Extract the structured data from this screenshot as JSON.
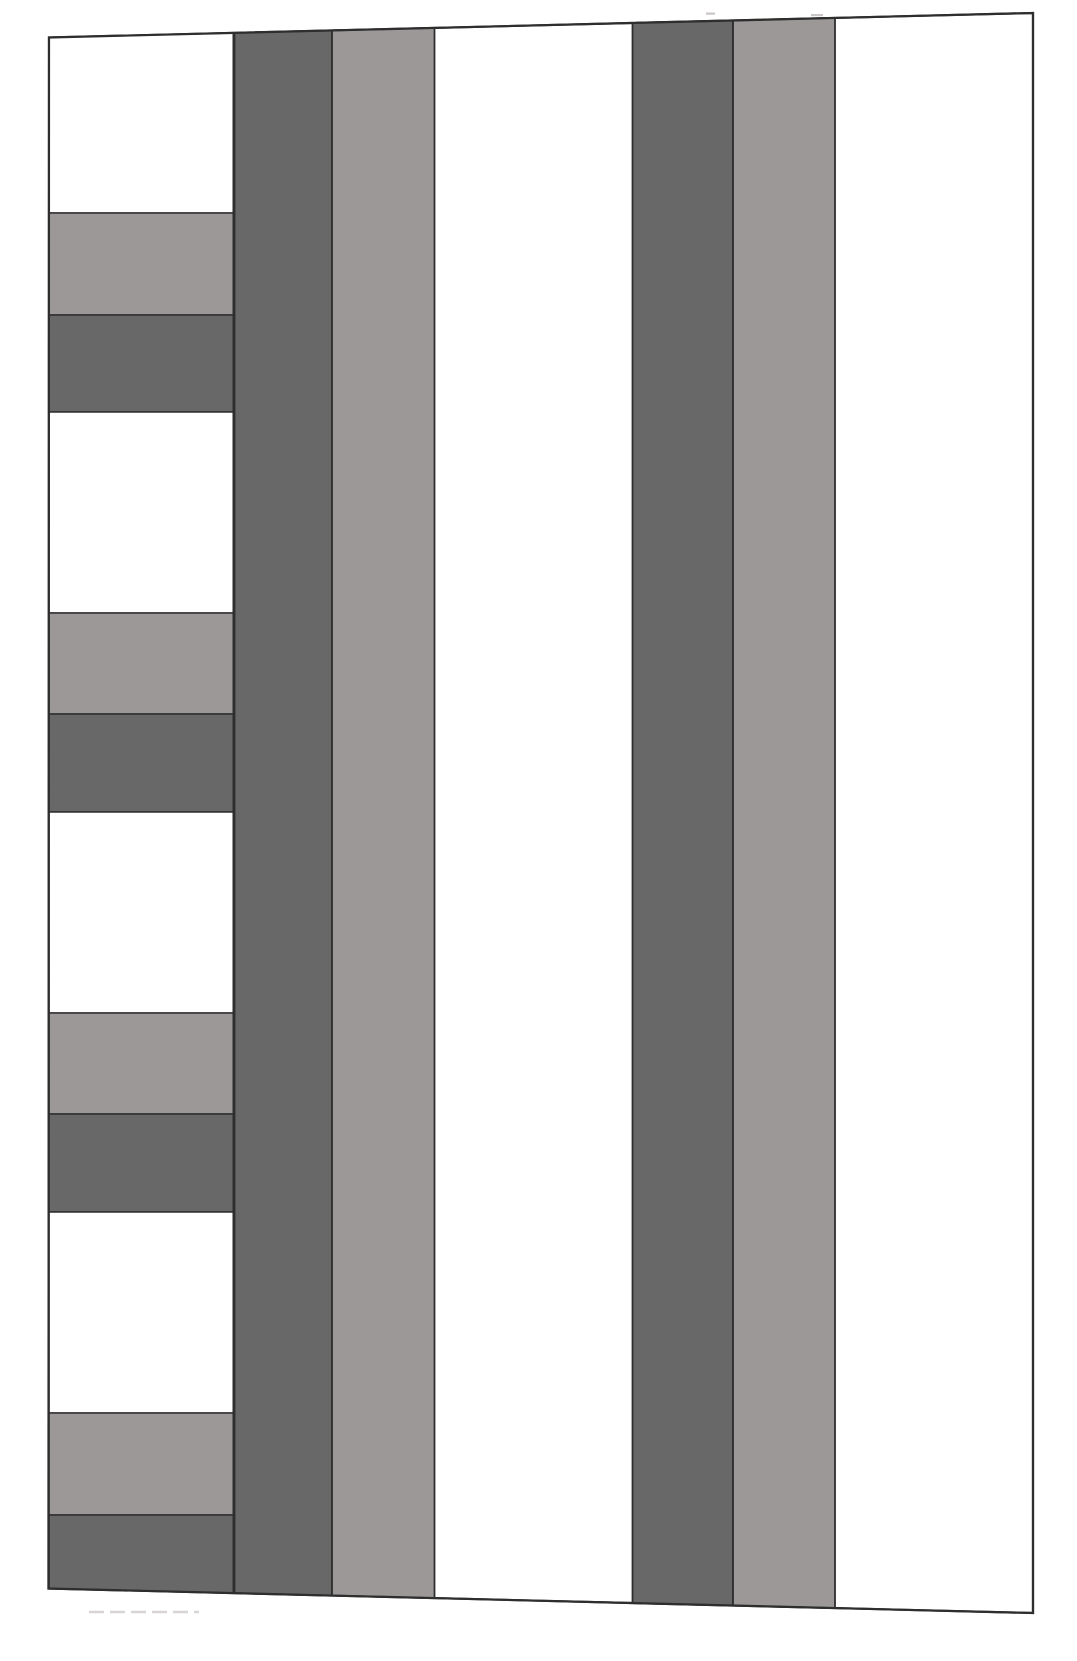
{
  "canvas": {
    "width": 1077,
    "height": 1661,
    "background": "#ffffff"
  },
  "palette": {
    "white": "#ffffff",
    "light_gray": "#9c9898",
    "dark_gray": "#686868",
    "stroke": "#2e2e2e",
    "faint_mark": "#c9c6c5",
    "faint_dash": "#d8d5d4"
  },
  "drawing": {
    "outline": {
      "top_left": [
        49,
        37.5
      ],
      "top_right": [
        1033,
        13
      ],
      "bottom_right": [
        1033,
        1613
      ],
      "bottom_left": [
        48.5,
        1588.5
      ],
      "stroke_width": 2.2
    },
    "left_column": {
      "x0": 49,
      "x1": 233.3,
      "stroke_width": 1.6,
      "bands": [
        {
          "color": "white",
          "from": "top",
          "to": 213
        },
        {
          "color": "light_gray",
          "from": 213,
          "to": 315
        },
        {
          "color": "dark_gray",
          "from": 315,
          "to": 412
        },
        {
          "color": "white",
          "from": 412,
          "to": 613
        },
        {
          "color": "light_gray",
          "from": 613,
          "to": 714
        },
        {
          "color": "dark_gray",
          "from": 714,
          "to": 812
        },
        {
          "color": "white",
          "from": 812,
          "to": 1013
        },
        {
          "color": "light_gray",
          "from": 1013,
          "to": 1114
        },
        {
          "color": "dark_gray",
          "from": 1114,
          "to": 1212
        },
        {
          "color": "white",
          "from": 1212,
          "to": 1413
        },
        {
          "color": "light_gray",
          "from": 1413,
          "to": 1515
        },
        {
          "color": "dark_gray",
          "from": 1515,
          "to": "bottom"
        }
      ]
    },
    "stripes": {
      "stroke_width": 1.8,
      "items": [
        {
          "name": "stripe-1-dark",
          "color": "dark_gray",
          "x0": 234.5,
          "x1": 332
        },
        {
          "name": "stripe-2-light",
          "color": "light_gray",
          "x0": 332,
          "x1": 434.5
        },
        {
          "name": "stripe-3-dark",
          "color": "dark_gray",
          "x0": 632.5,
          "x1": 733
        },
        {
          "name": "stripe-4-light",
          "color": "light_gray",
          "x0": 733,
          "x1": 835
        }
      ]
    },
    "artifacts": {
      "top_marks": [
        {
          "x": 706,
          "y": 12.5,
          "w": 9,
          "h": 2.2
        },
        {
          "x": 811,
          "y": 14,
          "w": 12,
          "h": 2.2
        }
      ],
      "bottom_dash_line": {
        "x0": 89,
        "x1": 199,
        "y": 1612,
        "width": 2.4,
        "dash": "15 6"
      }
    }
  }
}
